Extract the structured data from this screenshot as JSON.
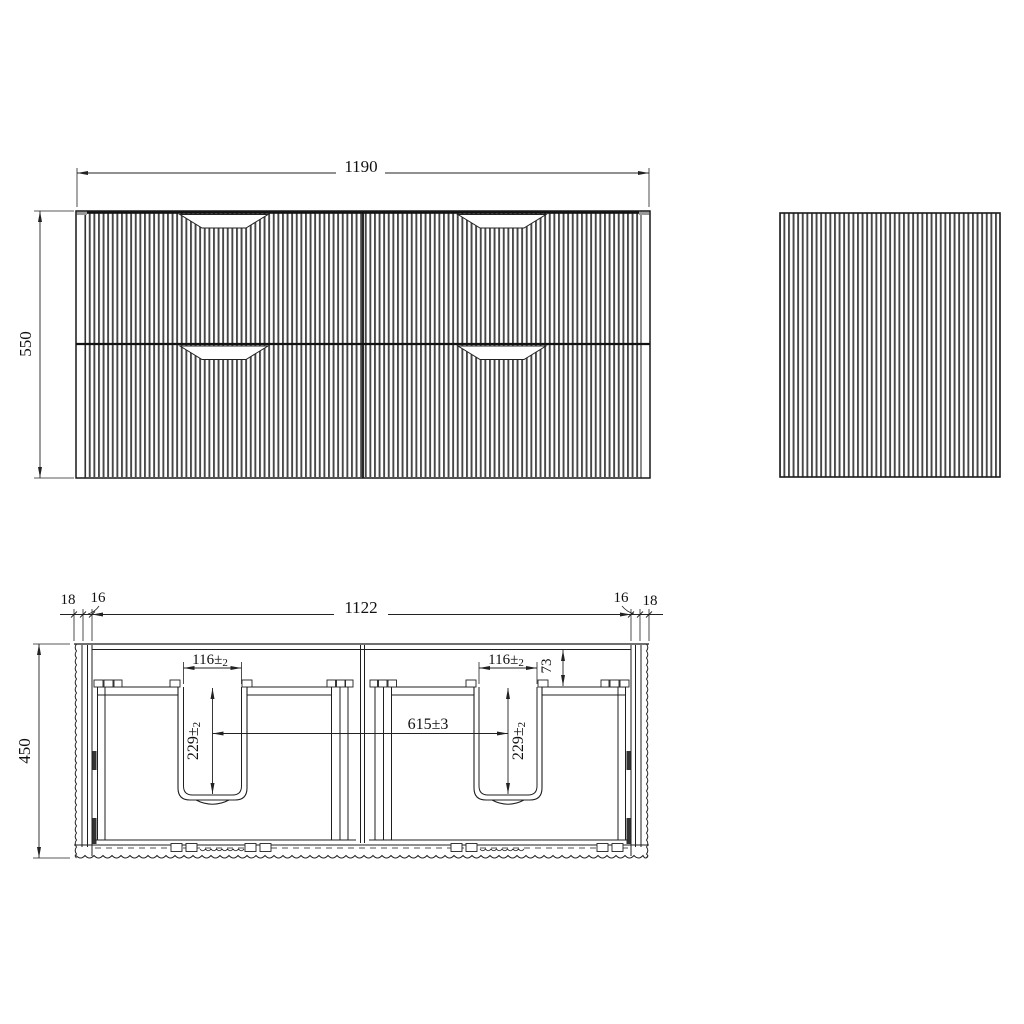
{
  "drawing": {
    "front_view": {
      "width": "1190",
      "height": "550"
    },
    "plan_view": {
      "inner_width": "1122",
      "depth": "450",
      "left_panel_thickness": "18",
      "left_side_thickness": "16",
      "right_side_thickness": "16",
      "right_panel_thickness": "18",
      "basin_cutout_width": "116±",
      "basin_cutout_width_tol": "2",
      "basin_cutout_depth": "229±",
      "basin_cutout_depth_tol": "2",
      "cutout_center_spacing": "615±3",
      "back_rail_gap": "73"
    }
  },
  "colors": {
    "line": "#1a1a1a",
    "flute": "#474747",
    "background": "#ffffff"
  }
}
